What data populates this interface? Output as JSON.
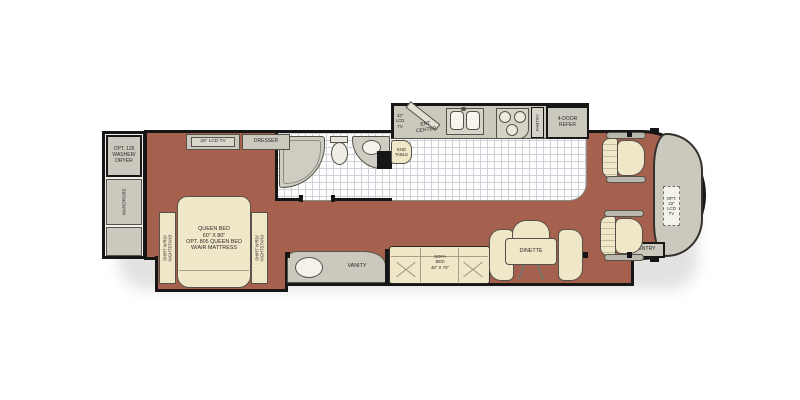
{
  "colors": {
    "carpet": "#a6604e",
    "furniture_cream": "#f0e7c8",
    "cabinet_gray": "#cbc8bd",
    "tile": "#fdfdfd",
    "wall": "#161616"
  },
  "bedroom": {
    "washer_dryer": "OPT. 126\nWASHER/\nDRYER",
    "wardrobe": "WARDROBE",
    "tv": "26\" LCD TV",
    "dresser": "DRESSER",
    "bed": "QUEEN BED\n60\" X 80\"\nOPT. 805 QUEEN BED\nW/AIR MATTRESS",
    "nightstand_left": "SHIRT W'RD/\nNIGHTSTAND",
    "nightstand_right": "SHIRT W'RD/\nNIGHTSTAND"
  },
  "midship": {
    "tv": "32\"\nLCD\nTV",
    "ent_center": "ENT\nCENTER",
    "end_table": "END\nTABLE",
    "vanity": "VANITY"
  },
  "kitchen": {
    "pantry": "PANTRY",
    "refrigerator": "4-DOOR\nREFER"
  },
  "living": {
    "sofa": "SOFA\nBED\n46\" X 76\"",
    "dinette": "DINETTE"
  },
  "cockpit": {
    "tv": "OPT.\n32\"\nLCD\nTV",
    "entry": "ENTRY"
  }
}
